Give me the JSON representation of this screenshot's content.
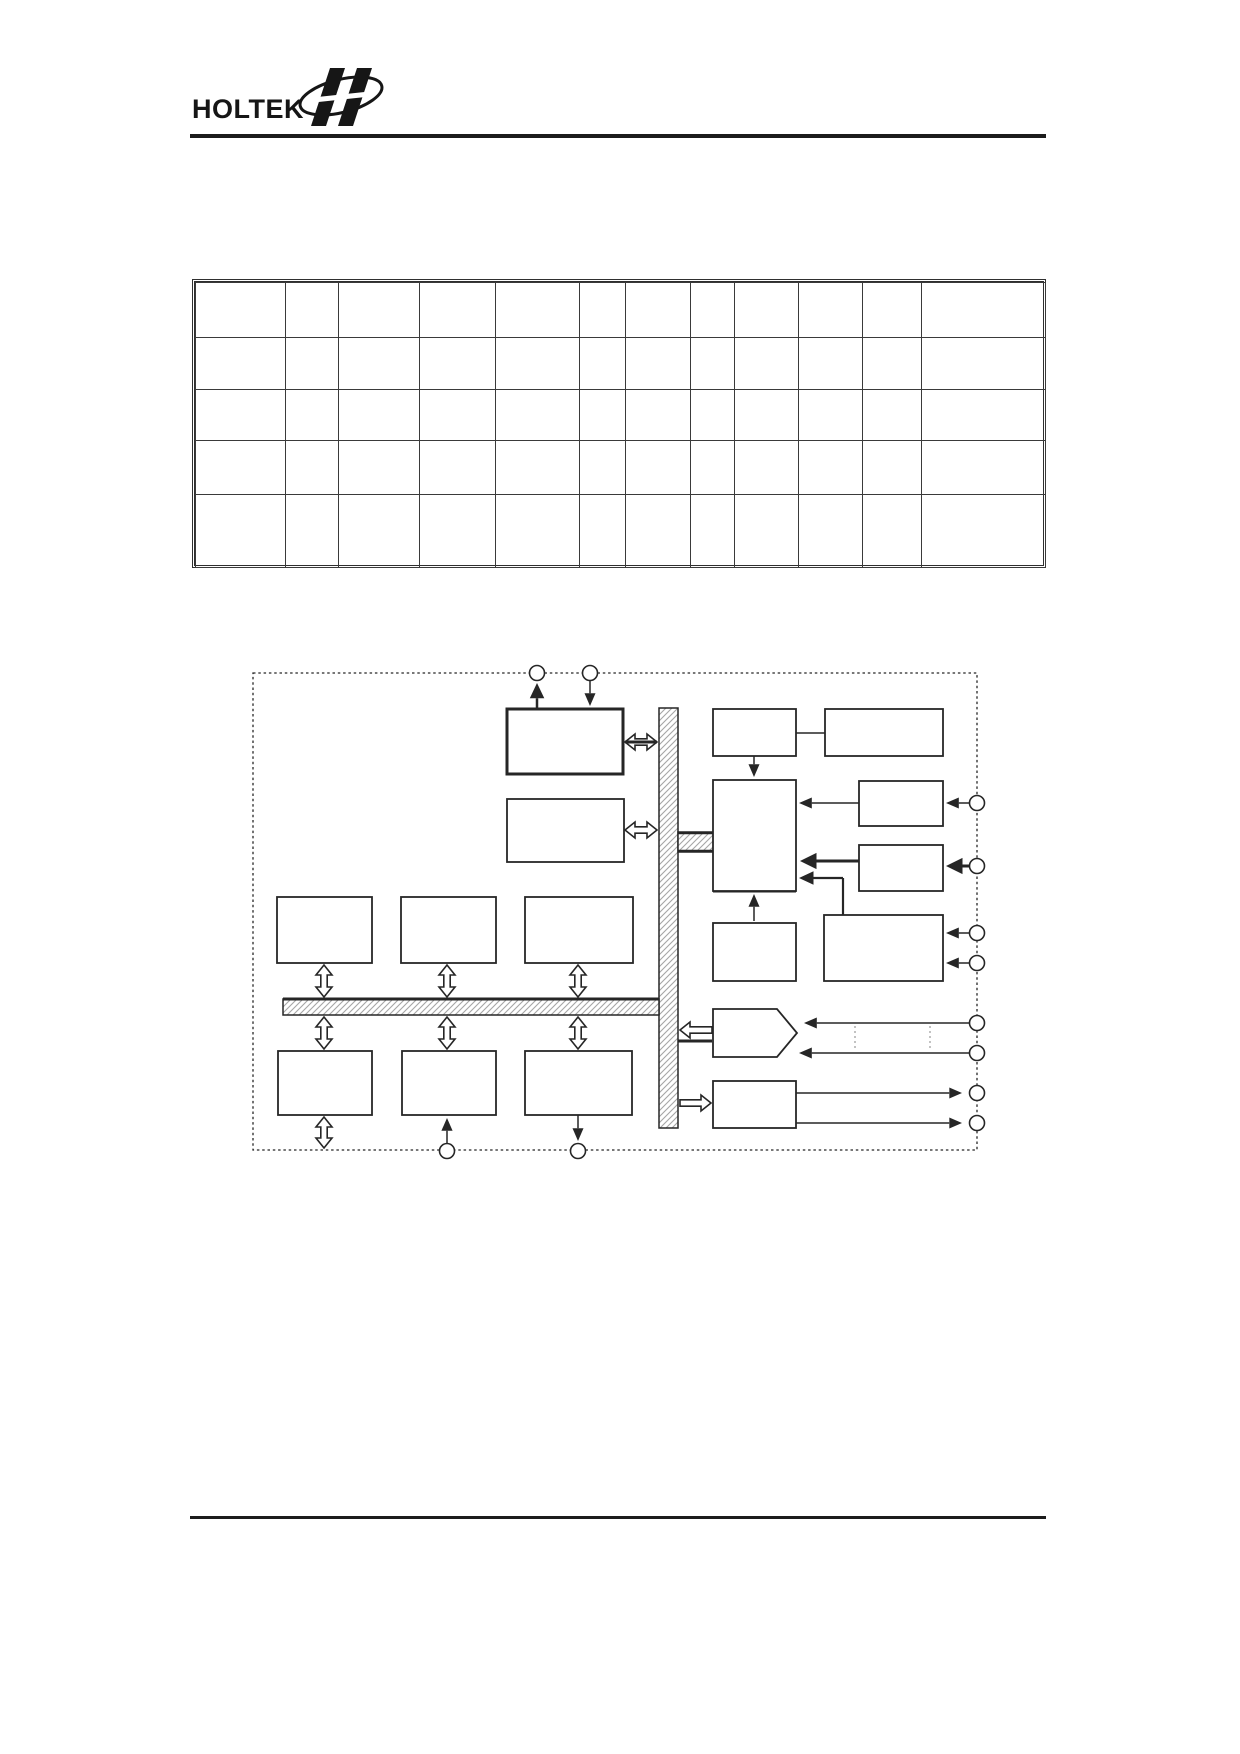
{
  "header": {
    "brand": "HOLTEK",
    "logo_icon": "holtek-wings-ellipse-icon",
    "rule_color": "#1c1c1c"
  },
  "table": {
    "columns": 12,
    "rows": 5,
    "col_widths": [
      90,
      53,
      81,
      76,
      84,
      46,
      65,
      44,
      64,
      64,
      59,
      124
    ],
    "row_heights": [
      55,
      52,
      51,
      54,
      73
    ],
    "cells_empty": true
  },
  "diagram": {
    "ink": "#262626",
    "hatch_color": "#a6a6a6",
    "frame": {
      "x": 253,
      "y": 673,
      "w": 724,
      "h": 477,
      "style": "dashed"
    },
    "buses": [
      {
        "name": "vertical-bus",
        "x": 659,
        "y": 708,
        "w": 19,
        "h": 420
      },
      {
        "name": "horizontal-bus",
        "x": 283,
        "y": 999,
        "w": 376,
        "h": 16
      },
      {
        "name": "cpu-bus-stub",
        "x": 678,
        "y": 832,
        "w": 36,
        "h": 20
      }
    ],
    "bold_lines": [
      {
        "x1": 283,
        "y1": 999,
        "x2": 659,
        "y2": 999,
        "w": 3
      },
      {
        "x1": 678,
        "y1": 833,
        "x2": 714,
        "y2": 833,
        "w": 2.5
      },
      {
        "x1": 678,
        "y1": 851,
        "x2": 714,
        "y2": 851,
        "w": 2.5
      },
      {
        "x1": 713,
        "y1": 891,
        "x2": 796,
        "y2": 891,
        "w": 3
      },
      {
        "x1": 713,
        "y1": 924,
        "x2": 796,
        "y2": 924,
        "w": 3
      },
      {
        "x1": 713,
        "y1": 1082,
        "x2": 796,
        "y2": 1082,
        "w": 3
      },
      {
        "x1": 625,
        "y1": 742,
        "x2": 657,
        "y2": 742,
        "w": 3
      },
      {
        "x1": 678,
        "y1": 1041,
        "x2": 712,
        "y2": 1041,
        "w": 3
      }
    ],
    "boxes": [
      {
        "name": "box-top-center",
        "x": 507,
        "y": 709,
        "w": 116,
        "h": 65,
        "thick": true
      },
      {
        "name": "box-mid-center",
        "x": 507,
        "y": 799,
        "w": 117,
        "h": 63
      },
      {
        "name": "box-row1-left",
        "x": 277,
        "y": 897,
        "w": 95,
        "h": 66
      },
      {
        "name": "box-row1-middle",
        "x": 401,
        "y": 897,
        "w": 95,
        "h": 66
      },
      {
        "name": "box-row1-right",
        "x": 525,
        "y": 897,
        "w": 108,
        "h": 66
      },
      {
        "name": "box-row2-left",
        "x": 278,
        "y": 1051,
        "w": 94,
        "h": 64
      },
      {
        "name": "box-row2-middle",
        "x": 402,
        "y": 1051,
        "w": 94,
        "h": 64
      },
      {
        "name": "box-row2-right",
        "x": 525,
        "y": 1051,
        "w": 107,
        "h": 64
      },
      {
        "name": "box-right-top-small",
        "x": 713,
        "y": 709,
        "w": 83,
        "h": 47
      },
      {
        "name": "box-right-top-wide",
        "x": 825,
        "y": 709,
        "w": 118,
        "h": 47
      },
      {
        "name": "box-cpu",
        "x": 713,
        "y": 780,
        "w": 83,
        "h": 111
      },
      {
        "name": "box-right-a",
        "x": 859,
        "y": 781,
        "w": 84,
        "h": 45
      },
      {
        "name": "box-right-b",
        "x": 859,
        "y": 845,
        "w": 84,
        "h": 46
      },
      {
        "name": "box-below-cpu",
        "x": 713,
        "y": 923,
        "w": 83,
        "h": 58
      },
      {
        "name": "box-bottom-right-wide",
        "x": 824,
        "y": 915,
        "w": 119,
        "h": 66
      },
      {
        "name": "box-bottom-output",
        "x": 713,
        "y": 1081,
        "w": 83,
        "h": 47
      }
    ],
    "pentagon": {
      "name": "input-mux-pentagon",
      "points": "713,1009 777,1009 797,1033 777,1057 713,1057"
    },
    "connectors": [
      {
        "type": "line",
        "x1": 537,
        "y1": 709,
        "x2": 537,
        "y2": 683,
        "w": 2.5,
        "arrow": "end"
      },
      {
        "type": "line",
        "x1": 590,
        "y1": 681,
        "x2": 590,
        "y2": 706,
        "w": 1.5,
        "arrow": "end"
      },
      {
        "type": "line",
        "x1": 796,
        "y1": 733,
        "x2": 825,
        "y2": 733,
        "w": 1.5
      },
      {
        "type": "line",
        "x1": 754,
        "y1": 756,
        "x2": 754,
        "y2": 777,
        "w": 1.5,
        "arrow": "end"
      },
      {
        "type": "line",
        "x1": 859,
        "y1": 803,
        "x2": 799,
        "y2": 803,
        "w": 1.5,
        "arrow": "end"
      },
      {
        "type": "line",
        "x1": 969,
        "y1": 803,
        "x2": 946,
        "y2": 803,
        "w": 1.5,
        "arrow": "end"
      },
      {
        "type": "line",
        "x1": 859,
        "y1": 861,
        "x2": 800,
        "y2": 861,
        "w": 3,
        "arrow": "end"
      },
      {
        "type": "line",
        "x1": 969,
        "y1": 866,
        "x2": 946,
        "y2": 866,
        "w": 3,
        "arrow": "end"
      },
      {
        "type": "poly",
        "points": [
          [
            843,
            915
          ],
          [
            843,
            878
          ],
          [
            799,
            878
          ]
        ],
        "w": 2.2,
        "arrow": "end"
      },
      {
        "type": "line",
        "x1": 754,
        "y1": 921,
        "x2": 754,
        "y2": 894,
        "w": 1.5,
        "arrow": "end"
      },
      {
        "type": "line",
        "x1": 969,
        "y1": 933,
        "x2": 946,
        "y2": 933,
        "w": 1.5,
        "arrow": "end"
      },
      {
        "type": "line",
        "x1": 969,
        "y1": 963,
        "x2": 946,
        "y2": 963,
        "w": 1.5,
        "arrow": "end"
      },
      {
        "type": "line",
        "x1": 969,
        "y1": 1023,
        "x2": 804,
        "y2": 1023,
        "w": 1.5,
        "arrow": "end"
      },
      {
        "type": "line",
        "x1": 969,
        "y1": 1053,
        "x2": 799,
        "y2": 1053,
        "w": 1.5,
        "arrow": "end"
      },
      {
        "type": "line",
        "x1": 796,
        "y1": 1093,
        "x2": 962,
        "y2": 1093,
        "w": 1.5,
        "arrow": "end"
      },
      {
        "type": "line",
        "x1": 796,
        "y1": 1123,
        "x2": 962,
        "y2": 1123,
        "w": 1.5,
        "arrow": "end"
      },
      {
        "type": "line",
        "x1": 447,
        "y1": 1143,
        "x2": 447,
        "y2": 1118,
        "w": 1.5,
        "arrow": "end"
      },
      {
        "type": "line",
        "x1": 578,
        "y1": 1115,
        "x2": 578,
        "y2": 1141,
        "w": 1.5,
        "arrow": "end"
      }
    ],
    "hollow_arrows": [
      {
        "name": "bus-link-top",
        "x1": 625,
        "y1": 742,
        "x2": 657,
        "y2": 742,
        "heads": 2
      },
      {
        "name": "bus-link-mid",
        "x1": 625,
        "y1": 830,
        "x2": 657,
        "y2": 830,
        "heads": 2
      },
      {
        "name": "row1-left-link",
        "x1": 324,
        "y1": 965,
        "x2": 324,
        "y2": 997,
        "heads": 2
      },
      {
        "name": "row1-middle-link",
        "x1": 447,
        "y1": 965,
        "x2": 447,
        "y2": 997,
        "heads": 2
      },
      {
        "name": "row1-right-link",
        "x1": 578,
        "y1": 965,
        "x2": 578,
        "y2": 997,
        "heads": 2
      },
      {
        "name": "row2-left-link",
        "x1": 324,
        "y1": 1017,
        "x2": 324,
        "y2": 1049,
        "heads": 2
      },
      {
        "name": "row2-middle-link",
        "x1": 447,
        "y1": 1017,
        "x2": 447,
        "y2": 1049,
        "heads": 2
      },
      {
        "name": "row2-right-link",
        "x1": 578,
        "y1": 1017,
        "x2": 578,
        "y2": 1049,
        "heads": 2
      },
      {
        "name": "row2-left-down-link",
        "x1": 324,
        "y1": 1117,
        "x2": 324,
        "y2": 1148,
        "heads": 2
      },
      {
        "name": "mux-to-bus-arrow",
        "x1": 712,
        "y1": 1030,
        "x2": 680,
        "y2": 1030,
        "heads": 1
      },
      {
        "name": "bus-to-output-arrow",
        "x1": 680,
        "y1": 1103,
        "x2": 711,
        "y2": 1103,
        "heads": 1
      }
    ],
    "circles": [
      {
        "x": 537,
        "y": 673
      },
      {
        "x": 590,
        "y": 673
      },
      {
        "x": 977,
        "y": 803
      },
      {
        "x": 977,
        "y": 866
      },
      {
        "x": 977,
        "y": 933
      },
      {
        "x": 977,
        "y": 963
      },
      {
        "x": 977,
        "y": 1023
      },
      {
        "x": 977,
        "y": 1053
      },
      {
        "x": 977,
        "y": 1093
      },
      {
        "x": 977,
        "y": 1123
      },
      {
        "x": 447,
        "y": 1151
      },
      {
        "x": 578,
        "y": 1151
      }
    ],
    "ellipsis_marks": [
      {
        "x": 855,
        "y1": 1026,
        "y2": 1048
      },
      {
        "x": 930,
        "y1": 1026,
        "y2": 1048
      }
    ]
  },
  "footer": {
    "rule_color": "#1c1c1c"
  }
}
